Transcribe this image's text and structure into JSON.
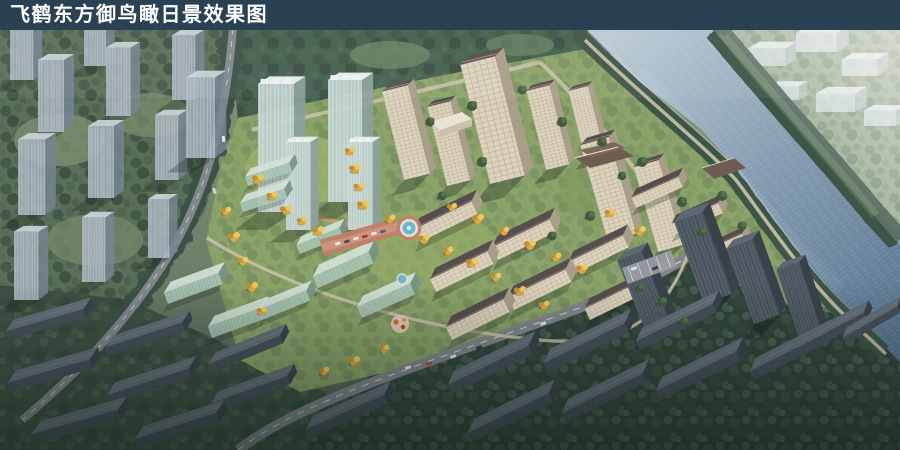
{
  "title_bar": {
    "title": "飞鹤东方御鸟瞰日景效果图"
  },
  "scene": {
    "palette": {
      "title_bar_bg": "#2a4153",
      "title_text": "#ffffff",
      "water_light": "#b9c9d4",
      "water": "#879eb2",
      "water_deep": "#54718e",
      "land": "#76886f",
      "forest": "#46604e",
      "far_land": "#95a88c",
      "dev_lawn": "#8ba368",
      "gold": "#d9a843",
      "wall": "#ddd3bd",
      "wall_shade": "#a99e8a",
      "roof": "#564d4c",
      "glass": "#bed0cd",
      "glass_green": "#a0bead",
      "context_glass": "#a5b2bc",
      "context_dark": "#4a545e",
      "context_dark_roof": "#636e79",
      "plaza": "#c08069",
      "fountain": "#6db6d2",
      "road": "#80868c",
      "path": "#cbc2aa",
      "bank_tree": "#3c5547",
      "haze": "#e7edf1"
    }
  }
}
